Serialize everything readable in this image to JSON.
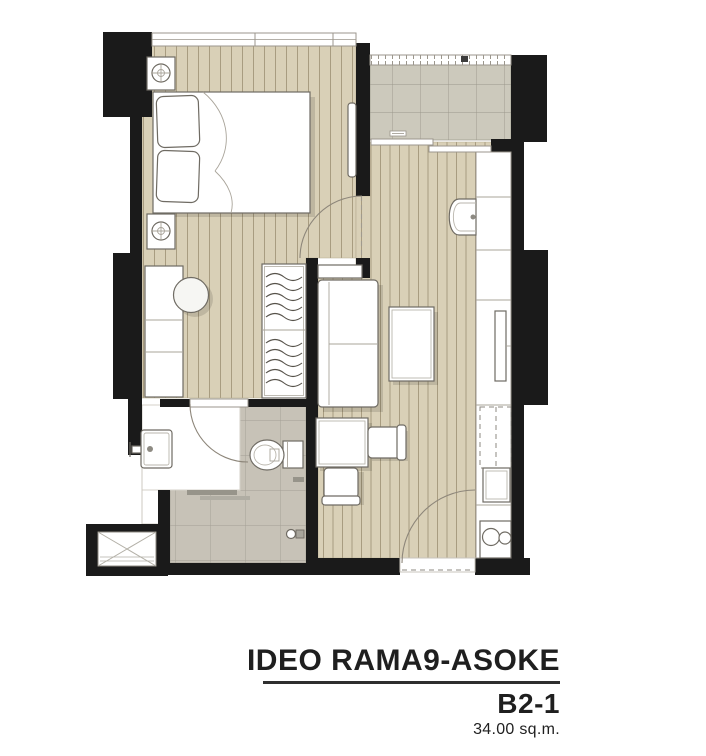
{
  "caption": {
    "project": "IDEO RAMA9-ASOKE",
    "unit": "B2-1",
    "area": "34.00 sq.m."
  },
  "palette": {
    "background": "#ffffff",
    "wall": "#1a1a1a",
    "wood-floor": "#d9d0b7",
    "wood-stripe": "#a89c80",
    "tile-balcony": "#ccc9bc",
    "tile-line": "#9a978b",
    "tile-bath": "#c7c2b7",
    "bath-line": "#a39f94",
    "furniture-stroke": "#6f6b63",
    "shadow": "rgba(0,0,0,0.12)",
    "caption-text": "#1f1f1f"
  },
  "rooms": [
    {
      "name": "bedroom"
    },
    {
      "name": "dressing-area"
    },
    {
      "name": "bathroom"
    },
    {
      "name": "living-kitchen"
    },
    {
      "name": "balcony"
    },
    {
      "name": "entry"
    },
    {
      "name": "ac-ledge"
    }
  ],
  "furniture": [
    "double-bed",
    "pillows",
    "nightstand-with-lamp",
    "nightstand-with-lamp",
    "vanity-desk",
    "stool",
    "wardrobe-with-hangers",
    "tall-mirror-panel",
    "sofa",
    "console-shelf",
    "coffee-table",
    "dining-table",
    "dining-chair",
    "dining-chair",
    "kitchen-counter",
    "kitchen-sink",
    "tv",
    "refrigerator-space",
    "built-in-oven",
    "stove-two-burners",
    "toilet",
    "wash-basin",
    "shower-set",
    "floor-drain",
    "balcony-railing",
    "sliding-door",
    "window-band",
    "swing-door",
    "ac-compressor-ledge"
  ]
}
